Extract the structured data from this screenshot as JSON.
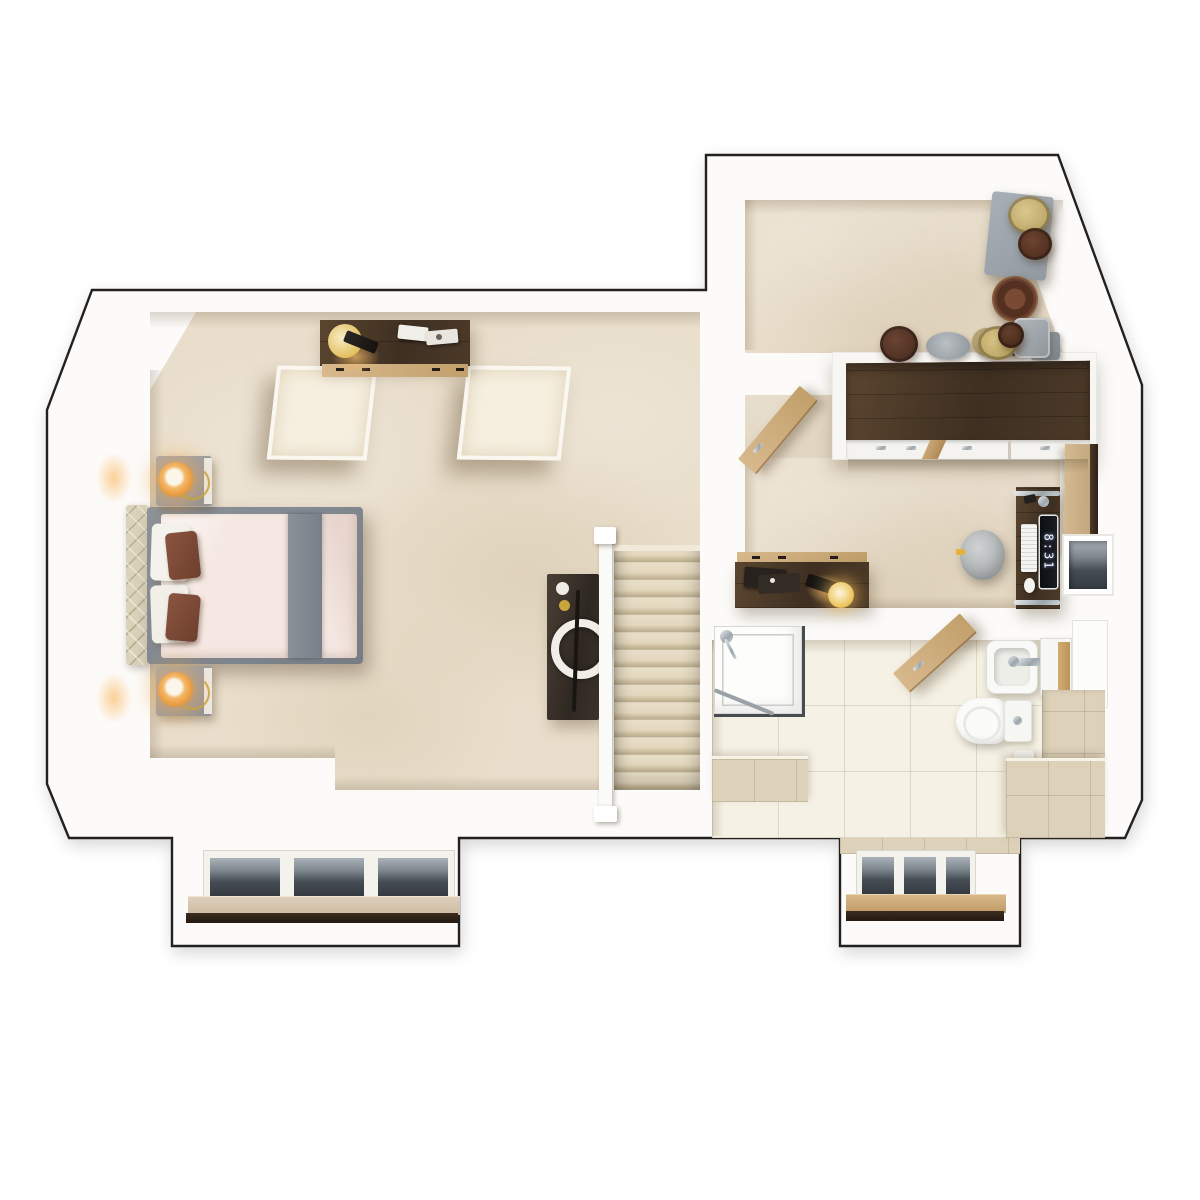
{
  "scene": {
    "kind": "3d-floor-plan-render",
    "view": "top-down-dollhouse",
    "clock": "8:31"
  },
  "palette": {
    "outline": "#23211f",
    "wall_white": "#fcfbf9",
    "carpet_beige": "#e9decb",
    "tile_cream": "#f5f1e4",
    "tile_beige": "#ddd1b9",
    "wood_dark_walnut": "#4a392c",
    "wood_oak": "#c9a876",
    "bed_frame_gray": "#848a91",
    "duvet_blush": "#f5e7e1",
    "pillow_brown": "#7c4a36",
    "headboard_cream": "#dbd2ba",
    "lamp_glow_amber": "#f2a84a",
    "window_glass": "#4c545a",
    "sanitary_white": "#f8f8f6",
    "storage_gray": "#99a1a8",
    "hatbox_tan": "#c8b173",
    "hatbox_brown": "#5c3526"
  },
  "regions": [
    {
      "name": "bedroom"
    },
    {
      "name": "dressing-area"
    },
    {
      "name": "bathroom"
    },
    {
      "name": "stairwell"
    },
    {
      "name": "dormer-bay-left"
    },
    {
      "name": "dormer-bay-right"
    }
  ],
  "fixtures": {
    "dormer_windows": {
      "count": 2,
      "panes_per_window": 3
    },
    "skylight_wells": {
      "count": 2
    },
    "stairs": {
      "visible_treads": 14
    },
    "doors_open": [
      "dressing-room-door",
      "bathroom-door"
    ]
  },
  "furniture": [
    "double-bed",
    "upholstered-headboard",
    "nightstand",
    "bedside-lamp",
    "wall-sconce",
    "bedroom-dresser",
    "cone-desk-lamp",
    "decor-trays",
    "console-table",
    "round-mirror-decor",
    "staircase",
    "handrail",
    "newel-post",
    "wardrobe",
    "storage-ottoman",
    "hat-boxes",
    "basket",
    "dressing-door",
    "desk",
    "monitor-clock",
    "keyboard",
    "mouse",
    "pouf-seat",
    "leaning-mirror",
    "wall-window",
    "landing-dresser",
    "shower-enclosure",
    "shower-head",
    "bathroom-door",
    "wash-basin",
    "mixer-tap",
    "vanity-cabinet",
    "tall-white-unit",
    "toilet",
    "cistern",
    "toilet-roll-holder",
    "tiled-bench",
    "tiled-ledge",
    "window-sill"
  ]
}
